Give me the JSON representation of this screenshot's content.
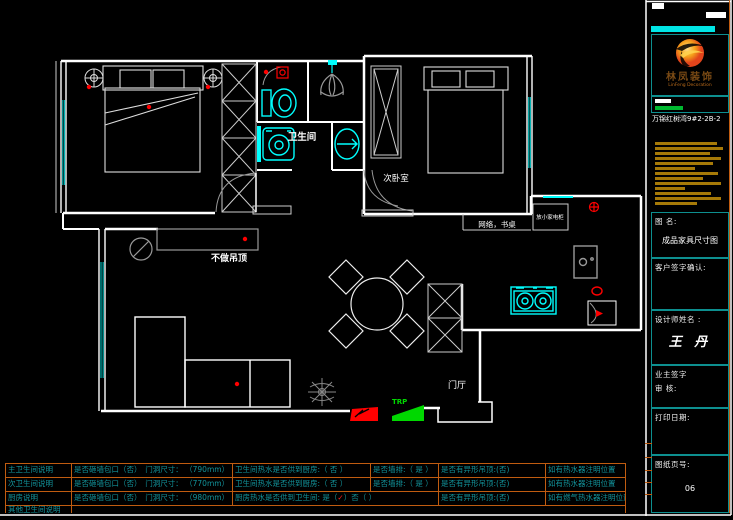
{
  "colors": {
    "wall": "#ffffff",
    "fixture_cyan": "#00ffff",
    "window_teal": "#00b0b0",
    "grid_orange": "#c05c10",
    "note_teal": "#12949c",
    "accent_red": "#ff0000",
    "accent_green": "#00d800",
    "gold": "#a67a08",
    "panel_border": "#0d8f8f"
  },
  "plan": {
    "labels": {
      "bathroom": "卫生间",
      "second_bedroom": "次卧室",
      "no_ceiling": "不做吊顶",
      "entry": "门厅",
      "network_desk": "网络，书桌",
      "appliance": "放小家电柜",
      "drain": "TRP"
    }
  },
  "title_block": {
    "company_cn": "林凤装饰",
    "company_en": "LinFeng Decoration",
    "project": "万锦红树湾9#2-2B-2",
    "drawing_label": "图 名:",
    "drawing_name": "成品家具尺寸图",
    "client_confirm": "客户签字确认:",
    "designer_label": "设计师姓名 :",
    "designer_name": "王 丹",
    "owner_sign": "业主签字",
    "review": "审  核:",
    "print_date": "打印日期:",
    "page_label": "图纸页号:",
    "page_no": "06"
  },
  "notes": {
    "rows": [
      {
        "label": "主卫生间说明",
        "open": "是否砸墙包口（否）　门洞尺寸： （790mm）",
        "hot": "卫生间热水是否供到厨房:（ 否  ）",
        "extra": "是否墙排:（ 是 ）",
        "ceiling": "是否有异形吊顶:(否)",
        "heater": "如有热水器注明位置"
      },
      {
        "label": "次卫生间说明",
        "open": "是否砸墙包口（否）　门洞尺寸： （770mm）",
        "hot": "卫生间热水是否供到厨房:（ 否 ）",
        "extra": "是否墙排:（ 是 ）",
        "ceiling": "是否有异形吊顶:(否)",
        "heater": "如有热水器注明位置"
      },
      {
        "label": "厨房说明",
        "open": "是否砸墙包口（否）　门洞尺寸： （980mm）",
        "hot_pre": "厨房热水是否供到卫生间:  是（",
        "check": "✓",
        "hot_post": "）否（  ）",
        "ceiling": "是否有异形吊顶:(否)",
        "heater": "如有燃气热水器注明位置"
      },
      {
        "label": "其他卫生间说明"
      }
    ]
  }
}
